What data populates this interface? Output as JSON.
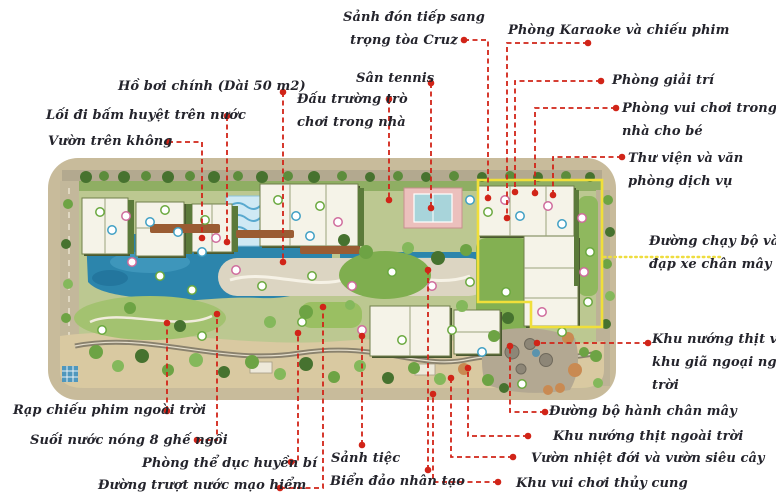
{
  "colors": {
    "leader_red": "#d12418",
    "leader_yellow": "#eedd3e",
    "label_ink": "#24242c",
    "jog_loop_yellow": "#f0df3a",
    "water": "#2c85ac",
    "lawn": "#7fae4f",
    "road": "#c8bb9b",
    "building": "#f5f3e8"
  },
  "labels": [
    {
      "id": "cruz-lobby",
      "lines": [
        "Sảnh đón tiếp sang",
        "trọng tòa Cruz"
      ],
      "x": 343,
      "y": 8,
      "w": 122,
      "align": "center",
      "leader": {
        "color": "red",
        "dots": true,
        "points": [
          [
            464,
            40
          ],
          [
            488,
            40
          ],
          [
            488,
            198
          ]
        ]
      }
    },
    {
      "id": "karaoke-room",
      "lines": [
        "Phòng Karaoke và chiếu phim"
      ],
      "x": 508,
      "y": 21,
      "w": 182,
      "align": "left",
      "leader": {
        "color": "red",
        "dots": true,
        "points": [
          [
            588,
            43
          ],
          [
            507,
            43
          ],
          [
            507,
            218
          ]
        ]
      }
    },
    {
      "id": "main-pool",
      "lines": [
        "Hồ bơi chính (Dài 50 m2)"
      ],
      "x": 118,
      "y": 77,
      "w": 158,
      "align": "left",
      "leader": {
        "color": "red",
        "dots": true,
        "points": [
          [
            283,
            92
          ],
          [
            283,
            262
          ]
        ]
      }
    },
    {
      "id": "tennis-court",
      "lines": [
        "Sân tennis"
      ],
      "x": 356,
      "y": 69,
      "w": 72,
      "align": "left",
      "leader": {
        "color": "red",
        "dots": true,
        "points": [
          [
            431,
            83
          ],
          [
            431,
            208
          ]
        ]
      }
    },
    {
      "id": "game-arena",
      "lines": [
        "Đấu trường trò",
        "chơi trong nhà"
      ],
      "x": 297,
      "y": 90,
      "w": 92,
      "align": "center",
      "leader": {
        "color": "red",
        "dots": true,
        "points": [
          [
            389,
            99
          ],
          [
            389,
            200
          ]
        ]
      }
    },
    {
      "id": "entertainment-room",
      "lines": [
        "Phòng giải trí"
      ],
      "x": 612,
      "y": 71,
      "w": 96,
      "align": "left",
      "leader": {
        "color": "red",
        "dots": true,
        "points": [
          [
            601,
            81
          ],
          [
            515,
            81
          ],
          [
            515,
            192
          ]
        ]
      }
    },
    {
      "id": "acupressure-walk",
      "lines": [
        "Lối đi bấm huyệt trên nước"
      ],
      "x": 46,
      "y": 106,
      "w": 174,
      "align": "left",
      "leader": {
        "color": "red",
        "dots": true,
        "points": [
          [
            227,
            116
          ],
          [
            227,
            242
          ]
        ]
      }
    },
    {
      "id": "kids-playroom",
      "lines": [
        "Phòng vui chơi trong",
        "nhà cho bé"
      ],
      "x": 622,
      "y": 99,
      "w": 152,
      "align": "left",
      "leader": {
        "color": "red",
        "dots": true,
        "points": [
          [
            616,
            108
          ],
          [
            535,
            108
          ],
          [
            535,
            193
          ]
        ]
      }
    },
    {
      "id": "sky-garden",
      "lines": [
        "Vườn trên không"
      ],
      "x": 48,
      "y": 132,
      "w": 106,
      "align": "left",
      "leader": {
        "color": "red",
        "dots": true,
        "points": [
          [
            168,
            142
          ],
          [
            202,
            142
          ],
          [
            202,
            238
          ]
        ]
      }
    },
    {
      "id": "library-office",
      "lines": [
        "Thư viện và văn",
        "phòng dịch vụ"
      ],
      "x": 628,
      "y": 149,
      "w": 146,
      "align": "left",
      "leader": {
        "color": "red",
        "dots": true,
        "points": [
          [
            622,
            157
          ],
          [
            553,
            157
          ],
          [
            553,
            195
          ]
        ]
      }
    },
    {
      "id": "jogging-cycling-path",
      "lines": [
        "Đường chạy bộ và",
        "đạp xe chân mây"
      ],
      "x": 649,
      "y": 232,
      "w": 126,
      "align": "left",
      "leader": {
        "color": "yellow",
        "dots": false,
        "points": [
          [
            720,
            257
          ],
          [
            602,
            257
          ]
        ]
      }
    },
    {
      "id": "bbq-picnic-area",
      "lines": [
        "Khu nướng thịt và",
        "khu giã ngoại ngoài",
        "trời"
      ],
      "x": 652,
      "y": 330,
      "w": 124,
      "align": "left",
      "leader": {
        "color": "red",
        "dots": true,
        "points": [
          [
            648,
            343
          ],
          [
            537,
            343
          ]
        ]
      }
    },
    {
      "id": "cloud-walkway",
      "lines": [
        "Đường bộ hành chân mây"
      ],
      "x": 549,
      "y": 402,
      "w": 152,
      "align": "left",
      "leader": {
        "color": "red",
        "dots": true,
        "points": [
          [
            545,
            412
          ],
          [
            510,
            412
          ],
          [
            510,
            346
          ]
        ]
      }
    },
    {
      "id": "outdoor-bbq",
      "lines": [
        "Khu nướng thịt ngoài trời"
      ],
      "x": 553,
      "y": 427,
      "w": 162,
      "align": "left",
      "leader": {
        "color": "red",
        "dots": true,
        "points": [
          [
            528,
            436
          ],
          [
            468,
            436
          ],
          [
            468,
            368
          ]
        ]
      }
    },
    {
      "id": "tropical-garden",
      "lines": [
        "Vườn nhiệt đới và vườn siêu cây"
      ],
      "x": 531,
      "y": 449,
      "w": 186,
      "align": "left",
      "leader": {
        "color": "red",
        "dots": true,
        "points": [
          [
            513,
            457
          ],
          [
            451,
            457
          ],
          [
            451,
            378
          ]
        ]
      }
    },
    {
      "id": "aquarium-playground",
      "lines": [
        "Khu vui chơi thủy cung"
      ],
      "x": 516,
      "y": 474,
      "w": 146,
      "align": "left",
      "leader": {
        "color": "red",
        "dots": true,
        "points": [
          [
            498,
            482
          ],
          [
            433,
            482
          ],
          [
            433,
            394
          ]
        ]
      }
    },
    {
      "id": "banquet-hall",
      "lines": [
        "Sảnh tiệc"
      ],
      "x": 331,
      "y": 449,
      "w": 64,
      "align": "left",
      "leader": {
        "color": "red",
        "dots": true,
        "points": [
          [
            362,
            445
          ],
          [
            362,
            336
          ]
        ]
      }
    },
    {
      "id": "artificial-island",
      "lines": [
        "Biển đảo nhân tạo"
      ],
      "x": 330,
      "y": 472,
      "w": 114,
      "align": "left",
      "leader": {
        "color": "red",
        "dots": true,
        "points": [
          [
            428,
            470
          ],
          [
            428,
            270
          ]
        ]
      }
    },
    {
      "id": "outdoor-cinema",
      "lines": [
        "Rạp chiếu phim ngoài trời"
      ],
      "x": 13,
      "y": 401,
      "w": 160,
      "align": "left",
      "leader": {
        "color": "red",
        "dots": true,
        "points": [
          [
            167,
            411
          ],
          [
            167,
            323
          ]
        ]
      }
    },
    {
      "id": "hot-spring",
      "lines": [
        "Suối nước nóng 8 ghế ngồi"
      ],
      "x": 30,
      "y": 431,
      "w": 162,
      "align": "left",
      "leader": {
        "color": "red",
        "dots": true,
        "points": [
          [
            197,
            440
          ],
          [
            217,
            440
          ],
          [
            217,
            314
          ]
        ]
      }
    },
    {
      "id": "gym-room",
      "lines": [
        "Phòng thể dục huyền bí"
      ],
      "x": 142,
      "y": 454,
      "w": 150,
      "align": "left",
      "leader": {
        "color": "red",
        "dots": true,
        "points": [
          [
            291,
            462
          ],
          [
            298,
            462
          ],
          [
            298,
            333
          ]
        ]
      }
    },
    {
      "id": "water-slide",
      "lines": [
        "Đường trượt nước mạo hiểm"
      ],
      "x": 98,
      "y": 476,
      "w": 168,
      "align": "left",
      "leader": {
        "color": "red",
        "dots": true,
        "points": [
          [
            280,
            488
          ],
          [
            323,
            488
          ],
          [
            323,
            307
          ]
        ]
      }
    }
  ]
}
